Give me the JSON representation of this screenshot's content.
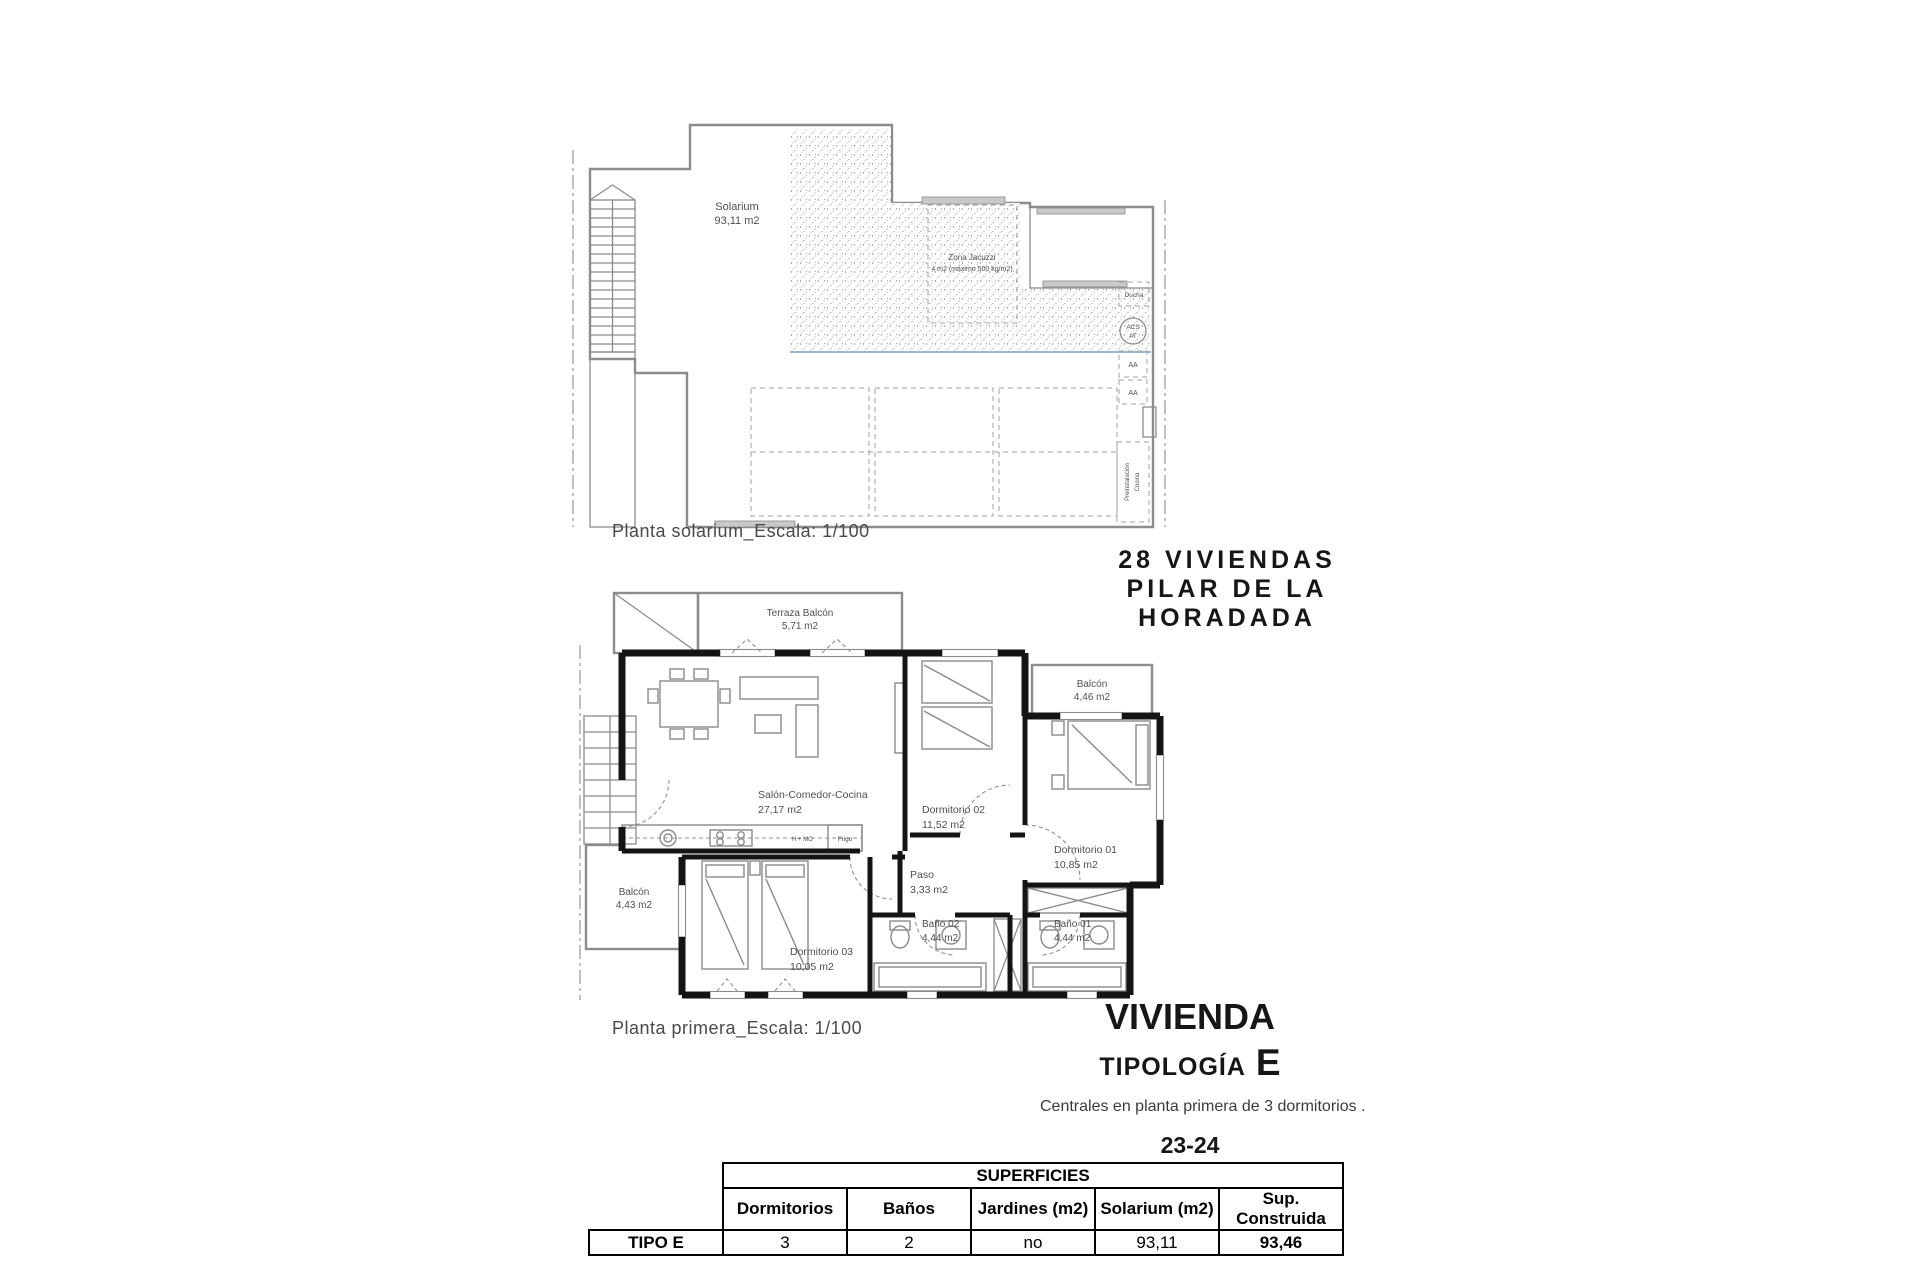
{
  "solarium_plan": {
    "caption": "Planta solarium_Escala: 1/100",
    "labels": {
      "solarium_name": "Solarium",
      "solarium_area": "93,11 m2",
      "jacuzzi_line1": "Zona Jacuzzi",
      "jacuzzi_line2": "4 m2 (máximo 500 kg/m2)",
      "ducha": "Ducha",
      "acs_line1": "ACS",
      "acs_line2": "AT",
      "aa1": "AA",
      "aa2": "AA",
      "preinst_line1": "Preinstalación",
      "preinst_line2": "Cocina"
    }
  },
  "project_heading": {
    "line1": "28 VIVIENDAS",
    "line2": "PILAR DE LA",
    "line3": "HORADADA"
  },
  "first_floor_plan": {
    "caption": "Planta primera_Escala: 1/100",
    "rooms": {
      "terraza": {
        "name": "Terraza Balcón",
        "area": "5,71 m2"
      },
      "balcon_dorm01": {
        "name": "Balcón",
        "area": "4,46 m2"
      },
      "salon": {
        "name": "Salón-Comedor-Cocina",
        "area": "27,17 m2"
      },
      "dorm02": {
        "name": "Dormitorio 02",
        "area": "11,52 m2"
      },
      "dorm01": {
        "name": "Dormitorio 01",
        "area": "10,85 m2"
      },
      "paso": {
        "name": "Paso",
        "area": "3,33 m2"
      },
      "bano02": {
        "name": "Baño 02",
        "area": "4,44 m2"
      },
      "bano01": {
        "name": "Baño 01",
        "area": "4,44 m2"
      },
      "dorm03": {
        "name": "Dormitorio 03",
        "area": "10,05 m2"
      },
      "balcon_dorm03": {
        "name": "Balcón",
        "area": "4,43 m2"
      },
      "kitchen_hob": "H + MO",
      "kitchen_fridge": "Frigo"
    }
  },
  "dwelling_title": {
    "main": "VIVIENDA",
    "tipologia": "TIPOLOGÍA",
    "letter": "E",
    "subtitle": "Centrales en planta primera de 3 dormitorios .",
    "units": "23-24"
  },
  "surfaces_table": {
    "group_header": "SUPERFICIES",
    "columns": [
      "Dormitorios",
      "Baños",
      "Jardines (m2)",
      "Solarium (m2)",
      "Sup. Construida"
    ],
    "row_label": "TIPO E",
    "values": [
      "3",
      "2",
      "no",
      "93,11",
      "93,46"
    ]
  },
  "colors": {
    "wall": "#141414",
    "linework": "#8c8c8c",
    "pool_edge": "#9db8cc"
  }
}
